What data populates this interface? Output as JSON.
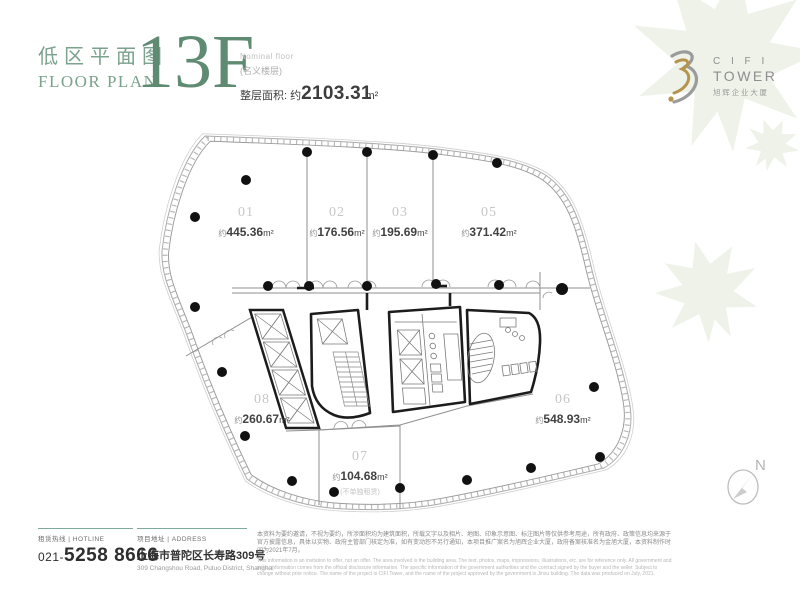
{
  "colors": {
    "accent_green": "#7aa28c",
    "floor_green": "#5f8b73",
    "logo_gold": "#b5954e",
    "logo_gray": "#9b9b9b",
    "rule_teal": "#7fa99a",
    "wall_black": "#1c1c1c",
    "leaf_watermark": "#eef2e9"
  },
  "header": {
    "title_cn": "低区平面图",
    "title_en": "FLOOR PLAN",
    "floor": "13F",
    "nominal_en": "Nominal floor",
    "nominal_cn": "(名义楼层)",
    "total_area_label": "整层面积: 约",
    "total_area_value": "2103.31",
    "total_area_unit": "m²"
  },
  "logo": {
    "line1": "C I F I",
    "line2": "TOWER",
    "line3": "旭辉企业大厦"
  },
  "plan": {
    "compass_label": "N",
    "units": [
      {
        "number": "01",
        "prefix": "约",
        "value": "445.36",
        "unit": "m²"
      },
      {
        "number": "02",
        "prefix": "约",
        "value": "176.56",
        "unit": "m²"
      },
      {
        "number": "03",
        "prefix": "约",
        "value": "195.69",
        "unit": "m²"
      },
      {
        "number": "05",
        "prefix": "约",
        "value": "371.42",
        "unit": "m²"
      },
      {
        "number": "06",
        "prefix": "约",
        "value": "548.93",
        "unit": "m²"
      },
      {
        "number": "07",
        "prefix": "约",
        "value": "104.68",
        "unit": "m²",
        "note": "(不单独租赁)"
      },
      {
        "number": "08",
        "prefix": "约",
        "value": "260.67",
        "unit": "m²"
      }
    ]
  },
  "footer": {
    "hotline_label": "租赁热线 | HOTLINE",
    "hotline_prefix": "021-",
    "hotline_number": "5258 8666",
    "address_label": "项目地址 | ADDRESS",
    "address_cn": "上海市普陀区长寿路309号",
    "address_en": "309 Changshou Road, Putuo District, Shanghai",
    "disclaimer_cn": "本资料为要约邀请，不视为要约，所涉面积均为建筑面积，所载文字以及相片、地图、印象示意图、标注图片等仅供参考用途，所有政府、政策信息均来源于官方披露信息，具体以实物、政府主管部门核定为准，如有变动恕不另行通知，本项目推广案名为旭辉企业大厦，政府备案核准名为金旭大厦，本资料制作时间为2021年7月。",
    "disclaimer_en": "This information is an invitation to offer, not an offer. The area involved is the building area. The text, photos, maps, impressions, illustrations, etc. are for reference only. All government and policy information comes from the official disclosure information. The specific information of the government authorities and the contract signed by the buyer and the seller. Subject to change without prior notice. The name of the project is CIFI Tower, and the name of the project approved by the government is Jinxu building. The data was produced on July, 2021."
  }
}
